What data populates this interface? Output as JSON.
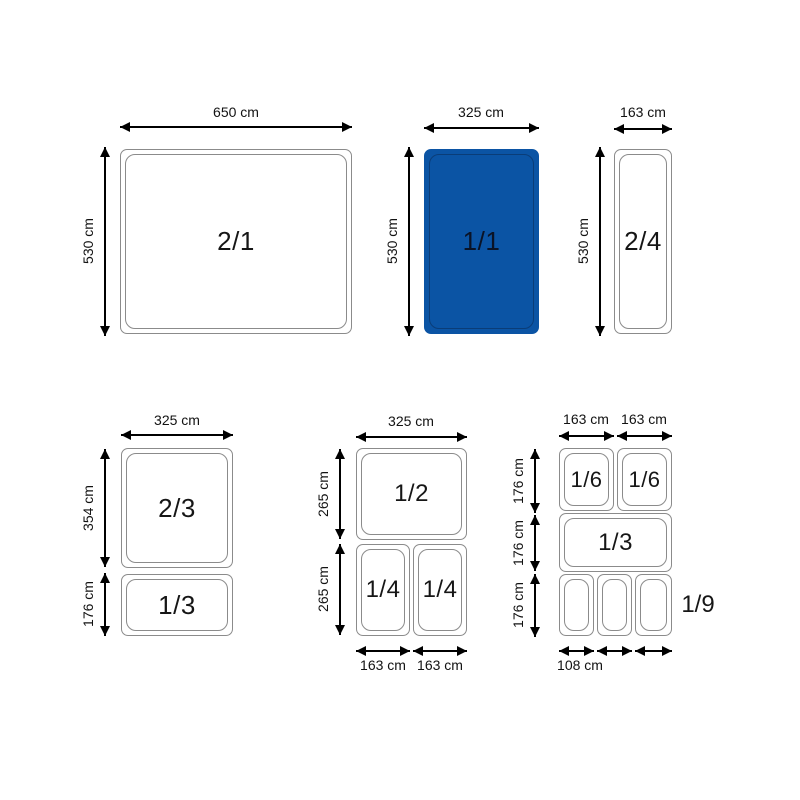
{
  "colors": {
    "highlight_blue": "#0b54a4",
    "highlight_blue_inner_line": "#0a3d78",
    "pan_outline_gray": "#8b8b8b",
    "arrow_black": "#000000"
  },
  "top_row": {
    "gn21": {
      "label": "2/1",
      "width": "650 cm",
      "height": "530 cm"
    },
    "gn11": {
      "label": "1/1",
      "width": "325 cm",
      "height": "530 cm"
    },
    "gn24": {
      "label": "2/4",
      "width": "163 cm",
      "height": "530 cm"
    }
  },
  "bottom_left": {
    "width": "325 cm",
    "gn23": {
      "label": "2/3",
      "height": "354 cm"
    },
    "gn13": {
      "label": "1/3",
      "height": "176 cm"
    }
  },
  "bottom_middle": {
    "width": "325 cm",
    "gn12": {
      "label": "1/2",
      "height": "265 cm"
    },
    "row2_height": "265 cm",
    "gn14a": {
      "label": "1/4",
      "width": "163 cm"
    },
    "gn14b": {
      "label": "1/4",
      "width": "163 cm"
    }
  },
  "bottom_right": {
    "col1_width": "163 cm",
    "col2_width": "163 cm",
    "row1_height": "176 cm",
    "row2_height": "176 cm",
    "row3_height": "176 cm",
    "gn16a": {
      "label": "1/6"
    },
    "gn16b": {
      "label": "1/6"
    },
    "gn13": {
      "label": "1/3"
    },
    "gn19_label": "1/9",
    "gn19_width": "108 cm"
  }
}
